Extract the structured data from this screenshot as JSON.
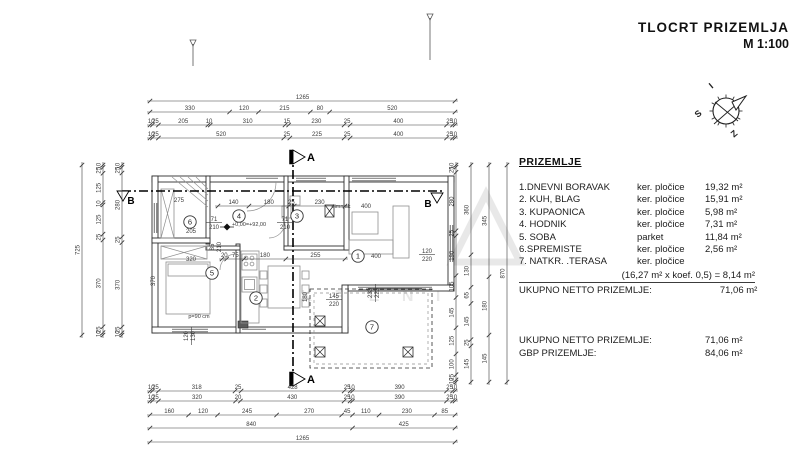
{
  "title": {
    "line1": "TLOCRT  PRIZEMLJA",
    "line2": "M 1:100"
  },
  "compass": {
    "letters": [
      "I",
      "S",
      "Z"
    ]
  },
  "legend": {
    "heading": "PRIZEMLJE",
    "rows": [
      {
        "name": "1.DNEVNI BORAVAK",
        "material": "ker. pločice",
        "area": "19,32 m²"
      },
      {
        "name": "2. KUH, BLAG",
        "material": "ker. pločice",
        "area": "15,91 m²"
      },
      {
        "name": "3. KUPAONICA",
        "material": "ker. pločice",
        "area": "5,98 m²"
      },
      {
        "name": "4. HODNIK",
        "material": "ker. pločice",
        "area": "7,31 m²"
      },
      {
        "name": "5. SOBA",
        "material": "parket",
        "area": "11,84 m²"
      },
      {
        "name": "6.SPREMISTE",
        "material": "ker. pločice",
        "area": "2,56 m²"
      },
      {
        "name": "7. NATKR. .TERASA",
        "material": "ker. pločice",
        "area": ""
      }
    ],
    "koef_line": "(16,27 m² x koef. 0,5) = 8,14 m²",
    "net_label": "UKUPNO NETTO PRIZEMLJE:",
    "net_value": "71,06 m²",
    "summary": [
      {
        "label": "UKUPNO NETTO  PRIZEMLJE:",
        "value": "71,06 m²"
      },
      {
        "label": "GBP  PRIZEMLJE:",
        "value": "84,06 m²"
      }
    ]
  },
  "watermark": {
    "text": "K R E N I"
  },
  "colors": {
    "ink": "#2e2e2e",
    "dim": "#3a3a3a",
    "light": "#8f8f8f",
    "watermark": "#e8e8e8"
  },
  "plan": {
    "section_labels": {
      "a": "A",
      "b": "B"
    },
    "dim_chains": [
      {
        "o": "h",
        "pos": 101,
        "a": 150,
        "b": 455,
        "vals": [
          "1265"
        ]
      },
      {
        "o": "h",
        "pos": 112,
        "a": 150,
        "b": 455,
        "vals": [
          "330",
          "120",
          "215",
          "80",
          "520"
        ]
      },
      {
        "o": "h",
        "pos": 125,
        "a": 150,
        "b": 455,
        "vals": [
          "10",
          "25",
          "205",
          "10",
          "310",
          "15",
          "230",
          "25",
          "400",
          "25",
          "10"
        ]
      },
      {
        "o": "h",
        "pos": 138,
        "a": 150,
        "b": 455,
        "vals": [
          "10",
          "25",
          "520",
          "25",
          "225",
          "25",
          "400",
          "25",
          "10"
        ]
      },
      {
        "o": "h",
        "pos": 391,
        "a": 150,
        "b": 455,
        "vals": [
          "10",
          "25",
          "318",
          "25",
          "428",
          "25",
          "10",
          "390",
          "25",
          "10"
        ]
      },
      {
        "o": "h",
        "pos": 401,
        "a": 150,
        "b": 455,
        "vals": [
          "10",
          "25",
          "320",
          "20",
          "430",
          "25",
          "10",
          "390",
          "25",
          "10"
        ]
      },
      {
        "o": "h",
        "pos": 415,
        "a": 150,
        "b": 455,
        "vals": [
          "160",
          "120",
          "245",
          "270",
          "45",
          "110",
          "230",
          "85"
        ]
      },
      {
        "o": "h",
        "pos": 428,
        "a": 150,
        "b": 455,
        "vals": [
          "840",
          "425"
        ]
      },
      {
        "o": "h",
        "pos": 442,
        "a": 150,
        "b": 455,
        "vals": [
          "1265"
        ]
      },
      {
        "o": "v",
        "pos": 82,
        "a": 165,
        "b": 335,
        "vals": [
          "725"
        ]
      },
      {
        "o": "v",
        "pos": 103,
        "a": 165,
        "b": 335,
        "vals": [
          "10",
          "25",
          "125",
          "10",
          "125",
          "25",
          "370",
          "25",
          "10"
        ]
      },
      {
        "o": "v",
        "pos": 122,
        "a": 165,
        "b": 335,
        "vals": [
          "10",
          "25",
          "280",
          "25",
          "370",
          "25",
          "10"
        ]
      },
      {
        "o": "v",
        "pos": 456,
        "a": 165,
        "b": 382,
        "vals": [
          "10",
          "25",
          "280",
          "25",
          "190",
          "105",
          "145",
          "125",
          "100",
          "25",
          "10"
        ]
      },
      {
        "o": "v",
        "pos": 471,
        "a": 165,
        "b": 382,
        "vals": [
          "360",
          "130",
          "65",
          "145",
          "25",
          "145"
        ]
      },
      {
        "o": "v",
        "pos": 489,
        "a": 165,
        "b": 382,
        "vals": [
          "345",
          "180",
          "145"
        ]
      },
      {
        "o": "v",
        "pos": 507,
        "a": 165,
        "b": 382,
        "vals": [
          "870"
        ]
      },
      {
        "o": "h",
        "pos": 206,
        "a": 218,
        "b": 345,
        "vals": [
          "140",
          "180",
          "25",
          "230"
        ]
      },
      {
        "o": "h",
        "pos": 259,
        "a": 222,
        "b": 345,
        "vals": [
          "20",
          "75",
          "180",
          "255"
        ]
      }
    ],
    "labels": [
      {
        "t": "205",
        "x": 191,
        "y": 233
      },
      {
        "t": "275",
        "x": 179,
        "y": 202
      },
      {
        "t": "320",
        "x": 191,
        "y": 261
      },
      {
        "t": "370",
        "x": 155,
        "y": 281,
        "r": -90
      },
      {
        "t": "p=90 cm",
        "x": 199,
        "y": 318
      },
      {
        "t": "+0,00=+92,00",
        "x": 249,
        "y": 226
      },
      {
        "t": "dimnjak",
        "x": 341,
        "y": 208
      },
      {
        "t": "400",
        "x": 366,
        "y": 208
      },
      {
        "t": "400",
        "x": 376,
        "y": 258
      },
      {
        "t": "85",
        "x": 214,
        "y": 247,
        "r": -90
      },
      {
        "t": "210",
        "x": 221,
        "y": 247,
        "r": -90
      },
      {
        "t": "180",
        "x": 307,
        "y": 297,
        "r": -90
      }
    ],
    "frac_labels": [
      {
        "top": "71",
        "bot": "210",
        "x": 214,
        "y": 222
      },
      {
        "top": "71",
        "bot": "210",
        "x": 285,
        "y": 222
      },
      {
        "top": "120",
        "bot": "220",
        "x": 427,
        "y": 254
      },
      {
        "top": "145",
        "bot": "220",
        "x": 334,
        "y": 299
      }
    ],
    "rot_pairs": [
      {
        "a": "120",
        "b": "130",
        "x": 188,
        "y": 336
      },
      {
        "a": "230",
        "b": "220",
        "x": 372,
        "y": 293
      }
    ],
    "rooms": [
      {
        "n": "1",
        "x": 358,
        "y": 256
      },
      {
        "n": "2",
        "x": 256,
        "y": 298
      },
      {
        "n": "3",
        "x": 297,
        "y": 216
      },
      {
        "n": "4",
        "x": 239,
        "y": 216
      },
      {
        "n": "5",
        "x": 212,
        "y": 273
      },
      {
        "n": "6",
        "x": 190,
        "y": 222
      },
      {
        "n": "7",
        "x": 372,
        "y": 327
      }
    ]
  }
}
